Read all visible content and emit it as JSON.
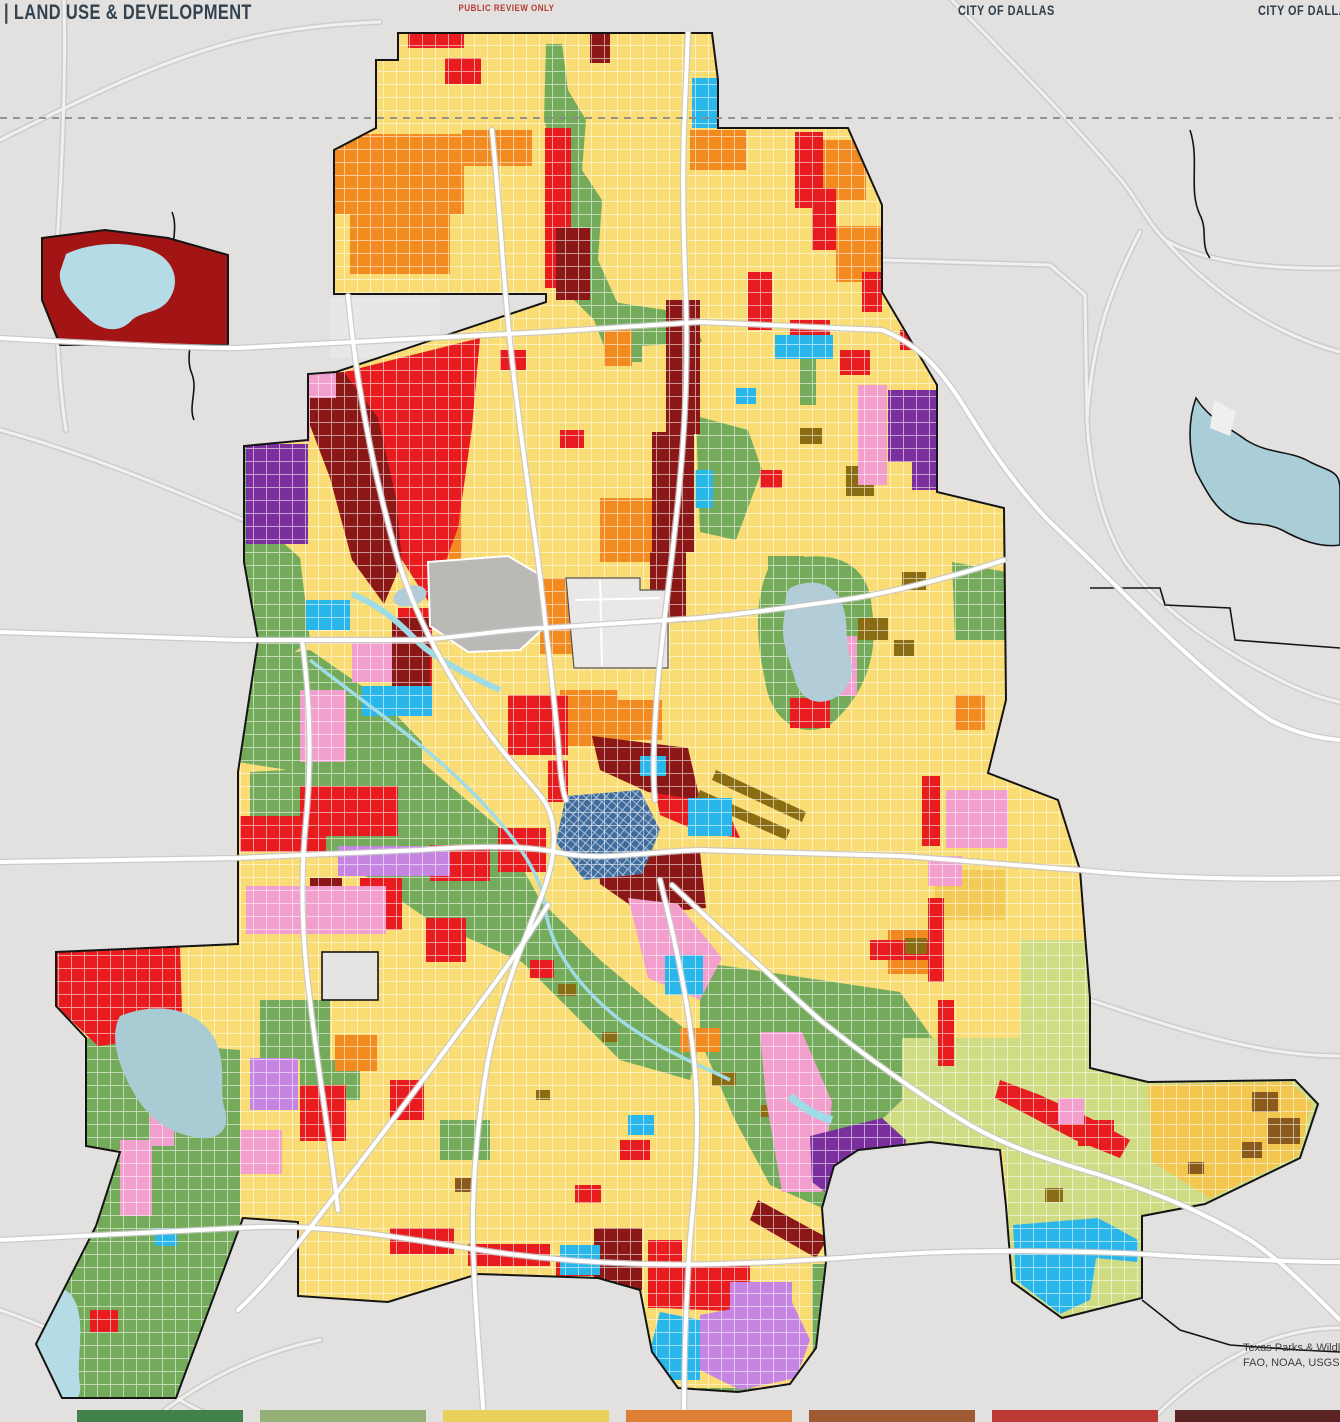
{
  "header": {
    "app_title": "| LAND USE & DEVELOPMENT",
    "watermark": "PUBLIC REVIEW ONLY",
    "city_label_1": "CITY OF DALLAS",
    "city_label_2": "CITY OF DALLAS"
  },
  "attribution": {
    "line1": "Texas Parks & Wildli",
    "line2": "FAO, NOAA, USGS, E"
  },
  "legend": {
    "swatch_colors": [
      "#41814a",
      "#94b077",
      "#e9d05b",
      "#de7f36",
      "#9d5a33",
      "#bb3a35",
      "#5a2423"
    ]
  },
  "palette": {
    "base_gray": "#e2e1df",
    "light_gray_patch": "#ececea",
    "yellow": "#f9dc74",
    "gold": "#f2c64f",
    "orange": "#f28a1f",
    "red": "#e81c1e",
    "dark_red": "#a31414",
    "maroon": "#8c1717",
    "khaki": "#8a6d12",
    "brown": "#8a5a1d",
    "green": "#74ab5b",
    "chartreuse": "#cfdc83",
    "pink": "#f29fce",
    "lavender": "#c685e2",
    "purple": "#7b2f9e",
    "cyan": "#29b6ea",
    "downtown_blue": "#3f6c9d",
    "water_gray": "#b2ccd8",
    "water_light": "#b5dce6",
    "aqua": "#9fdce6",
    "airport_gray": "#bab9b6",
    "enclave_gray": "#e9e8e6",
    "road_white": "#ffffff",
    "road_casing": "#c8c8c8",
    "boundary_black": "#141414",
    "dashed_line_gray": "#8a8a8a"
  }
}
